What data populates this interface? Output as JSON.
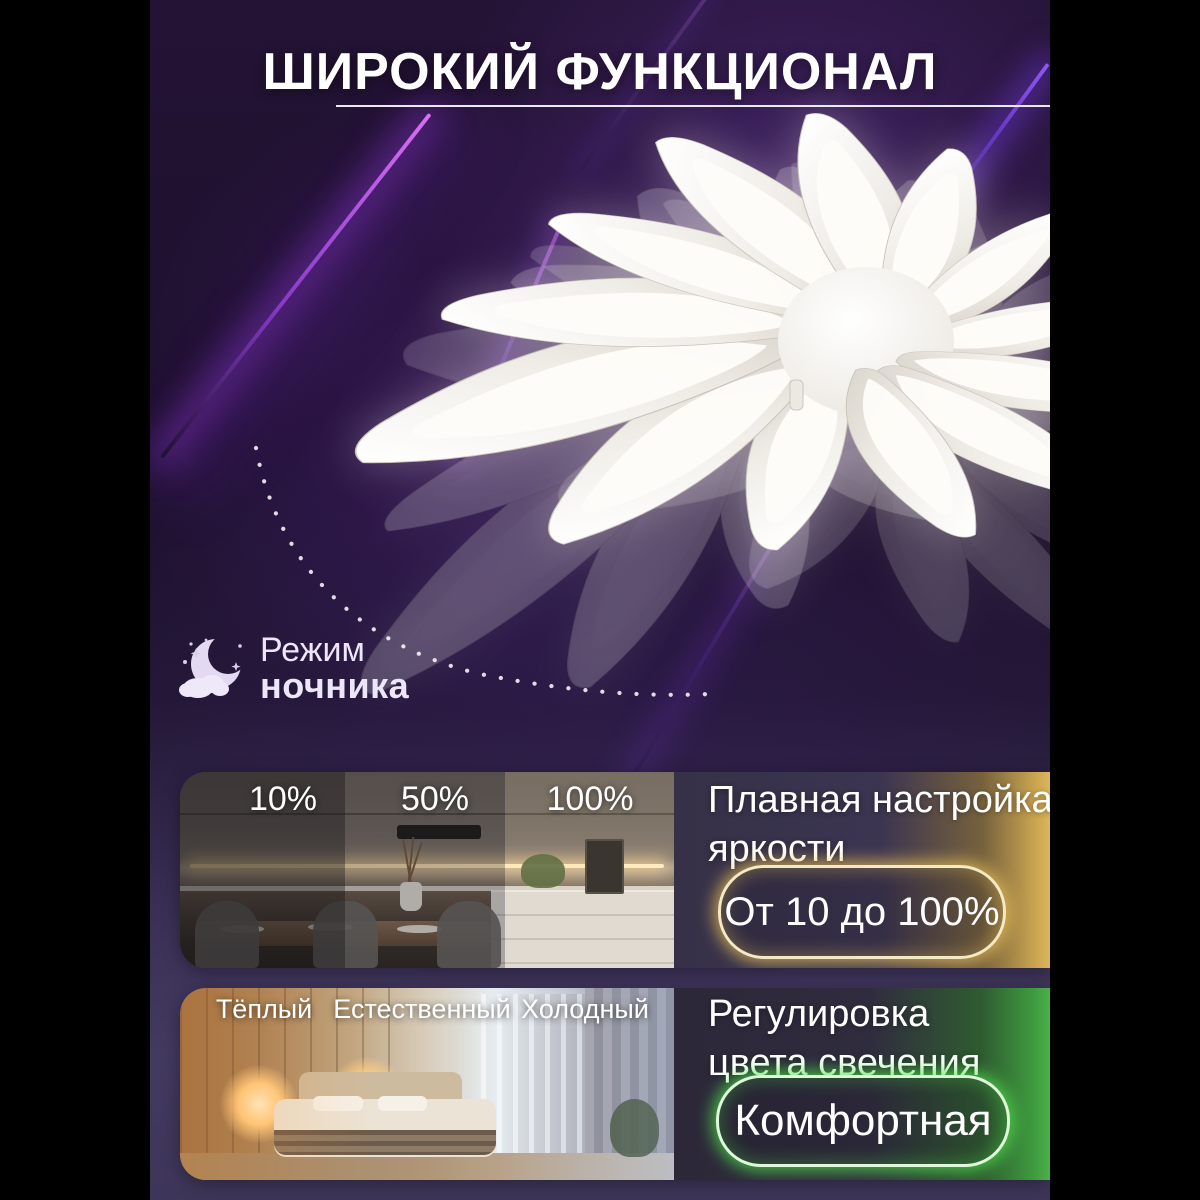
{
  "title": {
    "text": "ШИРОКИЙ ФУНКЦИОНАЛ"
  },
  "night_mode": {
    "word_regular": "Режим",
    "word_bold": "ночника",
    "icon": "moon-cloud-stars-icon"
  },
  "brightness_section": {
    "zone_labels": [
      "10%",
      "50%",
      "100%"
    ],
    "heading_line1": "Плавная настройка",
    "heading_line2": "яркости",
    "badge_text": "От 10 до 100%",
    "accent_color": "#e8c35f"
  },
  "color_temp_section": {
    "zone_labels": [
      "Тёплый",
      "Естественный",
      "Холодный"
    ],
    "heading_line1": "Регулировка",
    "heading_line2": "цвета свечения",
    "badge_text": "Комфортная",
    "accent_color": "#4ddb4a"
  },
  "colors": {
    "canvas_background": "#000000",
    "card_purple": "#241335",
    "beam_violet": "#a445e8",
    "text_white": "#ffffff"
  }
}
